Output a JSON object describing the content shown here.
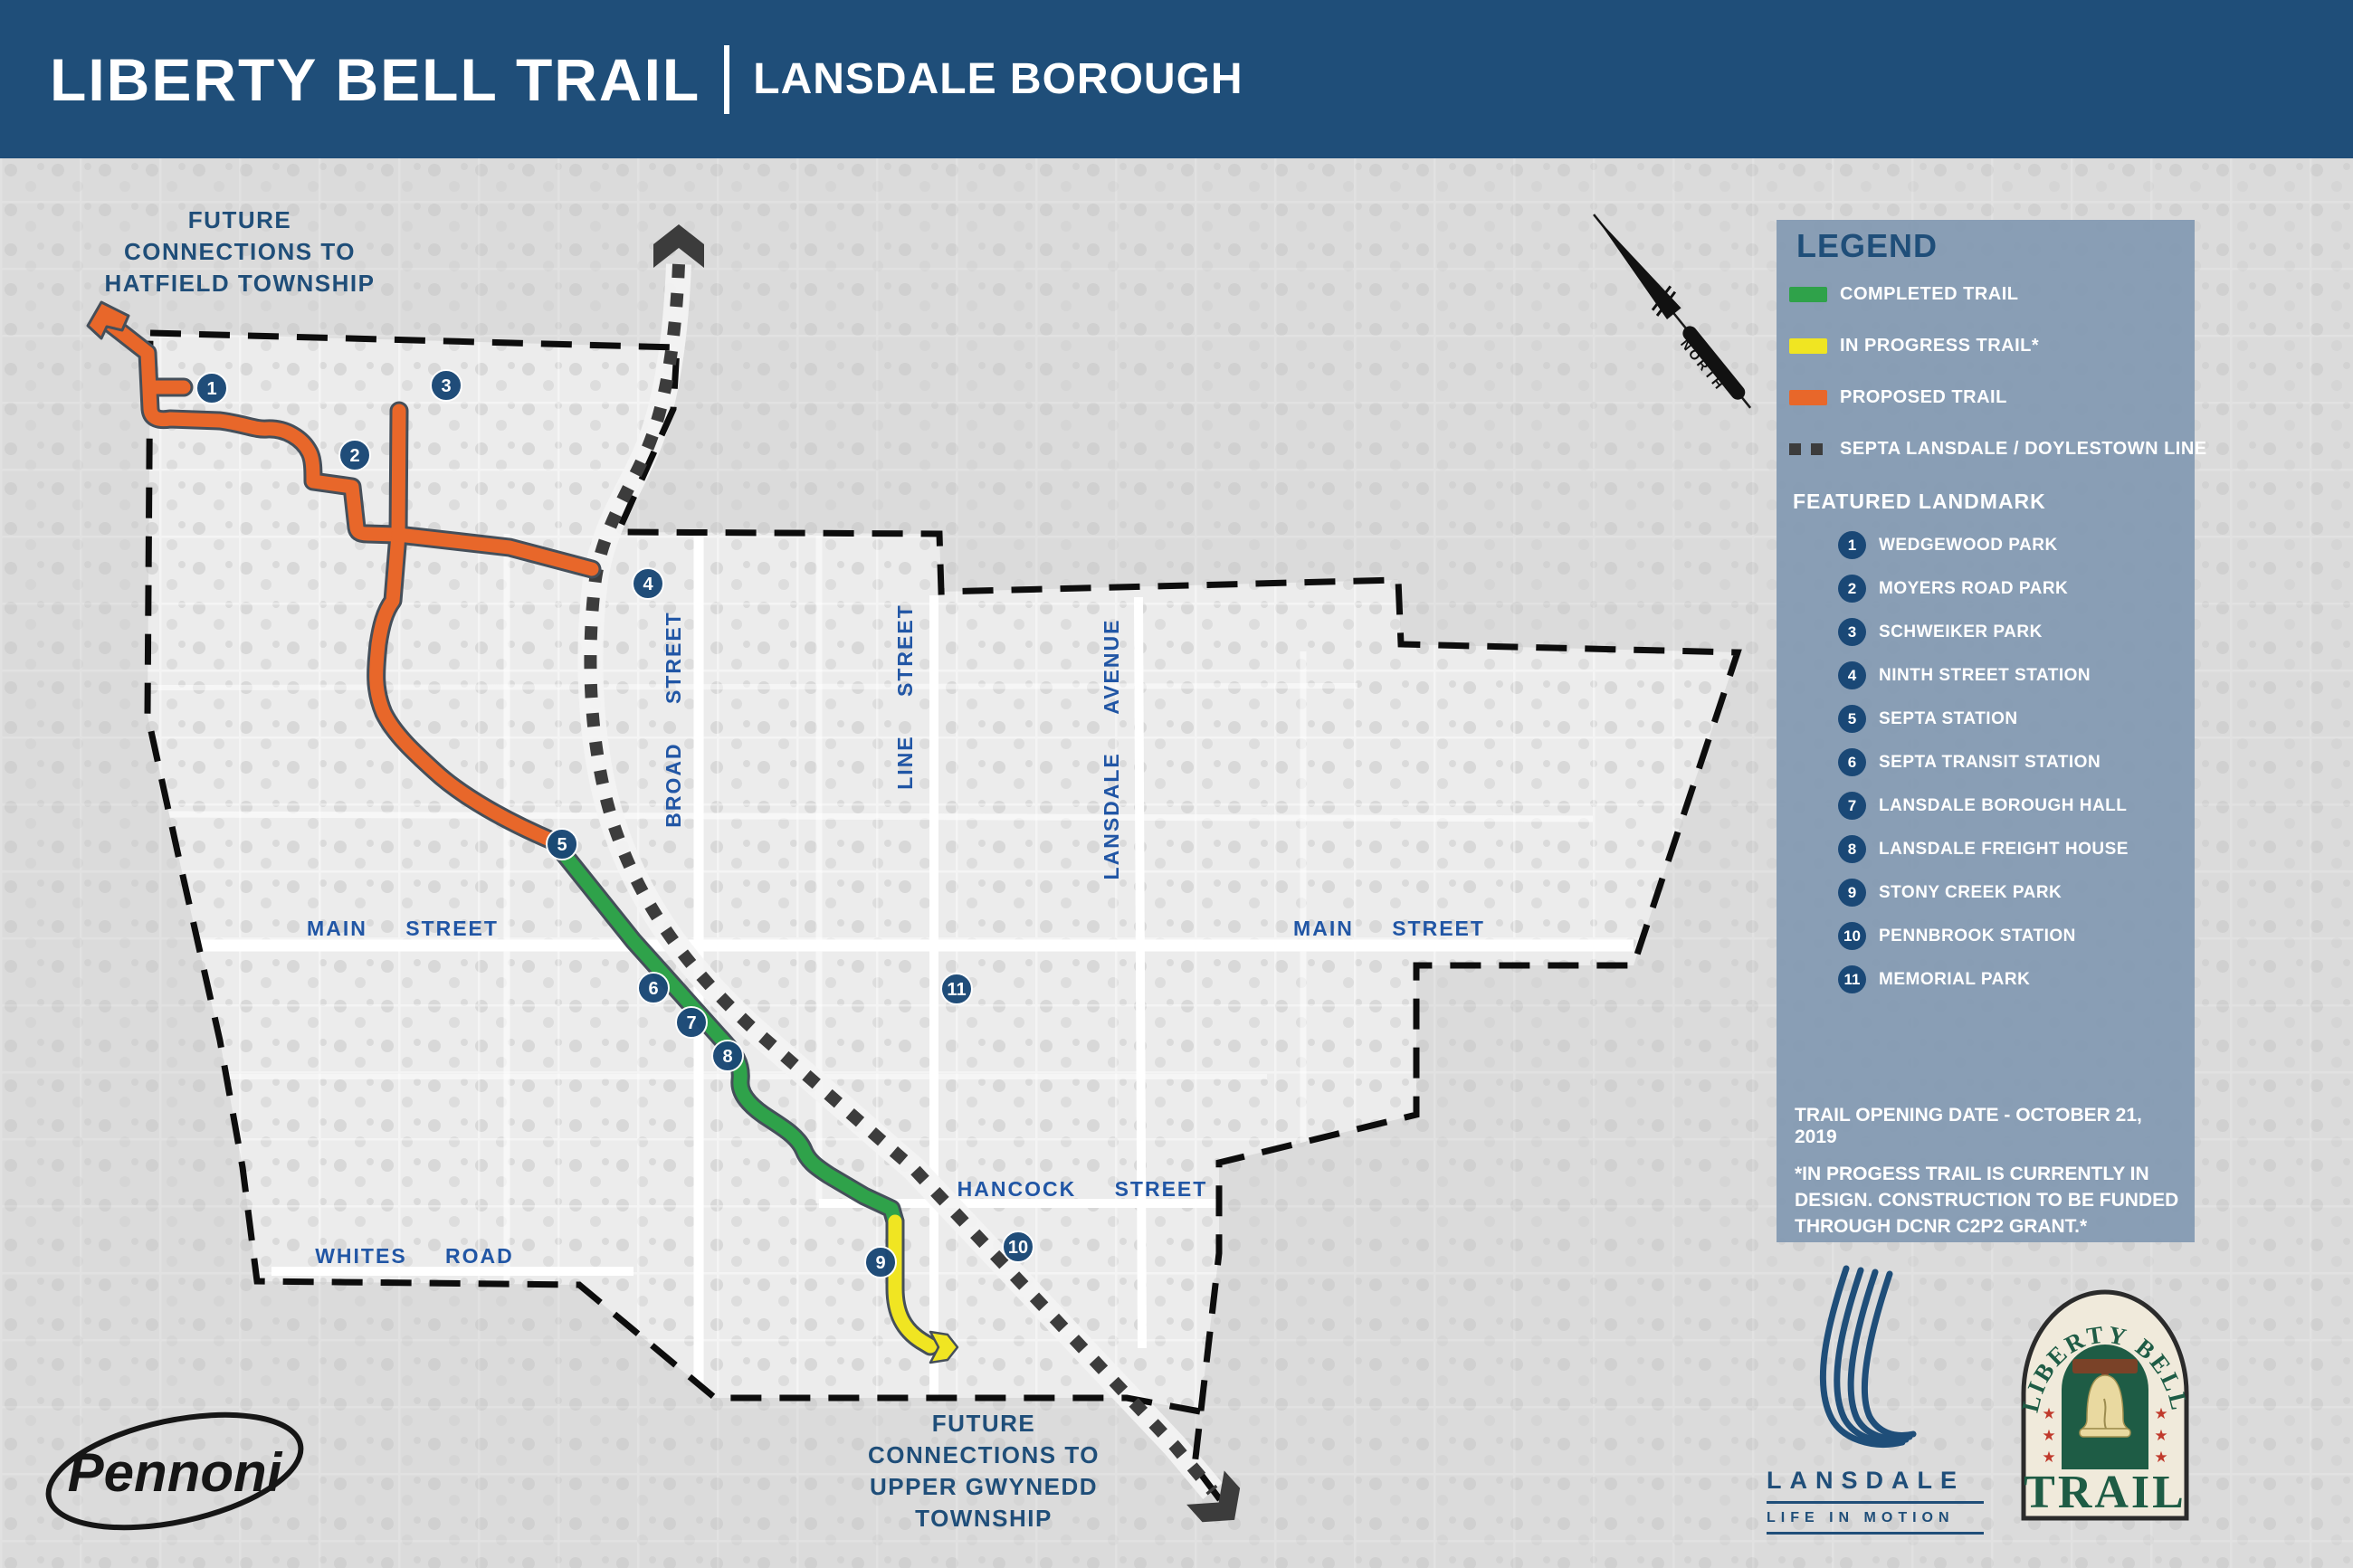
{
  "header": {
    "title": "LIBERTY BELL TRAIL",
    "separator": "|",
    "subtitle": "LANSDALE BOROUGH"
  },
  "map": {
    "north_note": [
      "FUTURE",
      "CONNECTIONS TO",
      "HATFIELD TOWNSHIP"
    ],
    "south_note": [
      "FUTURE",
      "CONNECTIONS TO",
      "UPPER GWYNEDD",
      "TOWNSHIP"
    ],
    "streets": [
      {
        "name": "MAIN STREET"
      },
      {
        "name": "MAIN STREET"
      },
      {
        "name": "WHITES ROAD"
      },
      {
        "name": "HANCOCK STREET"
      },
      {
        "name": "BROAD STREET"
      },
      {
        "name": "LINE STREET"
      },
      {
        "name": "LANSDALE AVENUE"
      }
    ],
    "markers": [
      {
        "n": "1"
      },
      {
        "n": "2"
      },
      {
        "n": "3"
      },
      {
        "n": "4"
      },
      {
        "n": "5"
      },
      {
        "n": "6"
      },
      {
        "n": "7"
      },
      {
        "n": "8"
      },
      {
        "n": "9"
      },
      {
        "n": "10"
      },
      {
        "n": "11"
      }
    ],
    "compass_label": "NORTH",
    "trail_colors": {
      "completed": "#2FA24A",
      "in_progress": "#F0E522",
      "proposed": "#E8672A",
      "septa": "#3C3C3C"
    }
  },
  "legend": {
    "title": "LEGEND",
    "items": [
      {
        "label": "COMPLETED TRAIL",
        "color": "#2FA24A"
      },
      {
        "label": "IN PROGRESS TRAIL*",
        "color": "#F0E522"
      },
      {
        "label": "PROPOSED TRAIL",
        "color": "#E8672A"
      },
      {
        "label": "SEPTA LANSDALE / DOYLESTOWN LINE",
        "color": "#3C3C3C"
      }
    ],
    "landmarks_title": "FEATURED LANDMARK",
    "landmarks": [
      {
        "number": "1",
        "label": "WEDGEWOOD PARK"
      },
      {
        "number": "2",
        "label": "MOYERS ROAD PARK"
      },
      {
        "number": "3",
        "label": "SCHWEIKER PARK"
      },
      {
        "number": "4",
        "label": "NINTH STREET STATION"
      },
      {
        "number": "5",
        "label": "SEPTA STATION"
      },
      {
        "number": "6",
        "label": "SEPTA TRANSIT STATION"
      },
      {
        "number": "7",
        "label": "LANSDALE BOROUGH HALL"
      },
      {
        "number": "8",
        "label": "LANSDALE FREIGHT HOUSE"
      },
      {
        "number": "9",
        "label": "STONY CREEK PARK"
      },
      {
        "number": "10",
        "label": "PENNBROOK STATION"
      },
      {
        "number": "11",
        "label": "MEMORIAL PARK"
      }
    ],
    "opening_date": "TRAIL OPENING DATE - OCTOBER 21, 2019",
    "footnote": "*IN PROGESS TRAIL IS CURRENTLY IN DESIGN. CONSTRUCTION TO BE FUNDED THROUGH DCNR C2P2 GRANT.*"
  },
  "footer": {
    "pennoni": "Pennoni",
    "lansdale": {
      "name": "LANSDALE",
      "tagline": "LIFE IN MOTION"
    },
    "trail_logo": {
      "top": "LIBERTY BELL",
      "bottom": "TRAIL",
      "star": "★"
    }
  }
}
